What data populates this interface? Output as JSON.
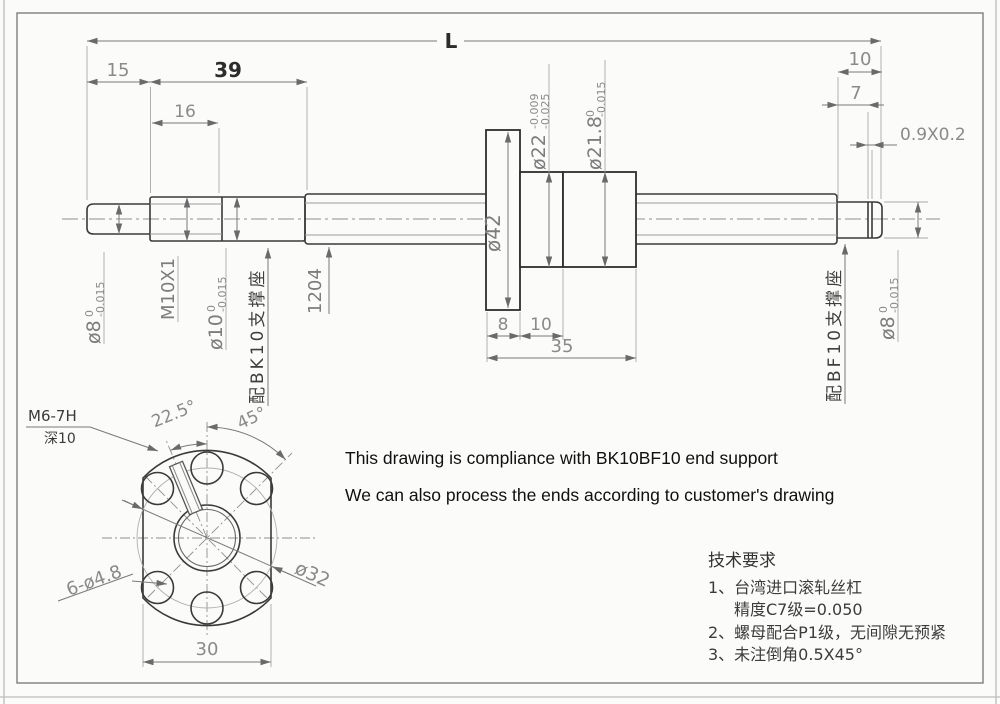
{
  "notes": {
    "line1": "This drawing is compliance with BK10BF10 end support",
    "line2": "We can also process the ends according to customer's drawing"
  },
  "tech_requirements": {
    "title": "技术要求",
    "item1": "1、台湾进口滚轧丝杠",
    "item1b": "精度C7级=0.050",
    "item2": "2、螺母配合P1级，无间隙无预紧",
    "item3": "3、未注倒角0.5X45°"
  },
  "side_view": {
    "overall_length": "L",
    "dim_left_15": "15",
    "dim_left_39": "39",
    "dim_left_16": "16",
    "dim_right_10": "10",
    "dim_right_7": "7",
    "dim_groove": "0.9X0.2",
    "dim_flange_8": "8",
    "dim_nut_10": "10",
    "dim_nut_35": "35",
    "label_screw_model": "1204",
    "label_thread": "M10X1",
    "label_bk10": "配BK10支撑座",
    "label_bf10": "配BF10支撑座",
    "label_flange_dia": "ø42",
    "d8_left": {
      "text": "ø8",
      "tol_upper": "0",
      "tol_lower": "-0.015"
    },
    "d10_left": {
      "text": "ø10",
      "tol_upper": "0",
      "tol_lower": "-0.015"
    },
    "d22_nut": {
      "text": "ø22",
      "tol_upper": "-0.009",
      "tol_lower": "-0.025"
    },
    "d218_nut": {
      "text": "ø21.8",
      "tol_upper": "0",
      "tol_lower": "-0.015"
    },
    "d8_right": {
      "text": "ø8",
      "tol_upper": "0",
      "tol_lower": "-0.015"
    }
  },
  "flange_view": {
    "label_m6": "M6-7H",
    "label_depth": "深10",
    "dim_angle_225": "22.5°",
    "dim_angle_45": "45°",
    "dim_holes": "6-ø4.8",
    "dim_bolt_circle": "ø32",
    "dim_width_30": "30"
  }
}
